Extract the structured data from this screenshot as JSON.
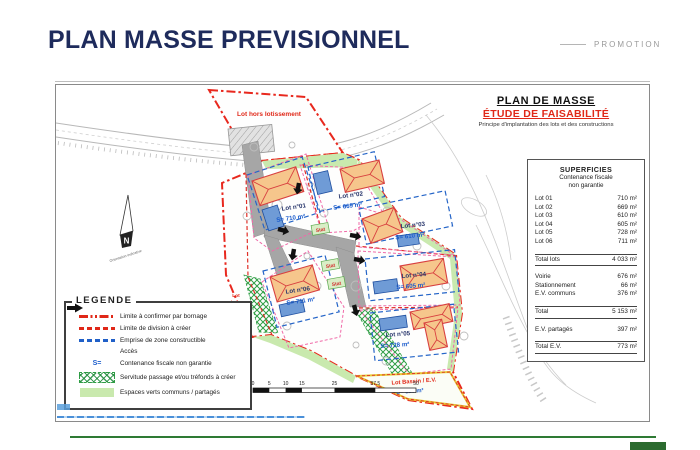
{
  "header": {
    "title": "PLAN MASSE PREVISIONNEL",
    "promotion": "PROMOTION"
  },
  "plan_header": {
    "title": "PLAN DE MASSE",
    "subtitle": "ÉTUDE DE FAISABILITÉ",
    "caption": "Principe d'implantation des lots et des constructions"
  },
  "superficies": {
    "title": "SUPERFICIES",
    "subtitle_line1": "Contenance fiscale",
    "subtitle_line2": "non garantie",
    "rows": [
      {
        "label": "Lot 01",
        "value": "710 m²"
      },
      {
        "label": "Lot 02",
        "value": "669 m²"
      },
      {
        "label": "Lot 03",
        "value": "610 m²"
      },
      {
        "label": "Lot 04",
        "value": "605 m²"
      },
      {
        "label": "Lot 05",
        "value": "728 m²"
      },
      {
        "label": "Lot 06",
        "value": "711 m²"
      }
    ],
    "total_lots": {
      "label": "Total lots",
      "value": "4 033 m²"
    },
    "infra_rows": [
      {
        "label": "Voirie",
        "value": "676 m²"
      },
      {
        "label": "Stationnement",
        "value": "66 m²"
      },
      {
        "label": "E.V. communs",
        "value": "376 m²"
      }
    ],
    "total": {
      "label": "Total",
      "value": "5 153 m²"
    },
    "ev_partages": {
      "label": "E.V. partagés",
      "value": "397 m²"
    },
    "total_ev": {
      "label": "Total E.V.",
      "value": "773 m²"
    }
  },
  "legend": {
    "title": "LEGENDE",
    "s_symbol": "S=",
    "items": [
      {
        "label": "Limite à confirmer par bornage"
      },
      {
        "label": "Limite de division à créer"
      },
      {
        "label": "Emprise de zone constructible"
      },
      {
        "label": "Accès"
      },
      {
        "label": "Contenance fiscale non garantie"
      },
      {
        "label": "Servitude passage et/ou tréfonds à créer"
      },
      {
        "label": "Espaces verts communs / partagés"
      }
    ]
  },
  "plan": {
    "hors_top": "Lot hors lotissement",
    "hors_left": [
      "Lot",
      "hors",
      "lotissement"
    ],
    "lots": [
      {
        "name": "Lot n°01",
        "area": "S= 710 m²"
      },
      {
        "name": "Lot n°02",
        "area": "S= 669 m²"
      },
      {
        "name": "Lot n°03",
        "area": "S= 610 m²"
      },
      {
        "name": "Lot n°04",
        "area": "S= 605 m²"
      },
      {
        "name": "Lot n°05",
        "area": "S= 728 m²"
      },
      {
        "name": "Lot n°06",
        "area": "S= 711 m²"
      }
    ],
    "bassin": {
      "name": "Lot Bassin / E.V.",
      "area": "S= 328 m²"
    },
    "stat_label": "Stat",
    "north_letter": "N",
    "north_caption": "Orientation indicative",
    "scale_ticks": [
      "0",
      "5",
      "10",
      "15",
      "25",
      "37.5",
      "50"
    ]
  },
  "colors": {
    "boundary_red": "#e8281e",
    "accent_red": "#e02818",
    "constructible_blue": "#2565c8",
    "division_pink": "#f06aa8",
    "label_blue": "#1b5ccc",
    "title_navy": "#1e2b5c",
    "ev_green": "#c9e9ae",
    "servitude_green": "#2f9e44",
    "road_gray": "#a6a6a6",
    "roof_orange": "#f6c68c"
  }
}
